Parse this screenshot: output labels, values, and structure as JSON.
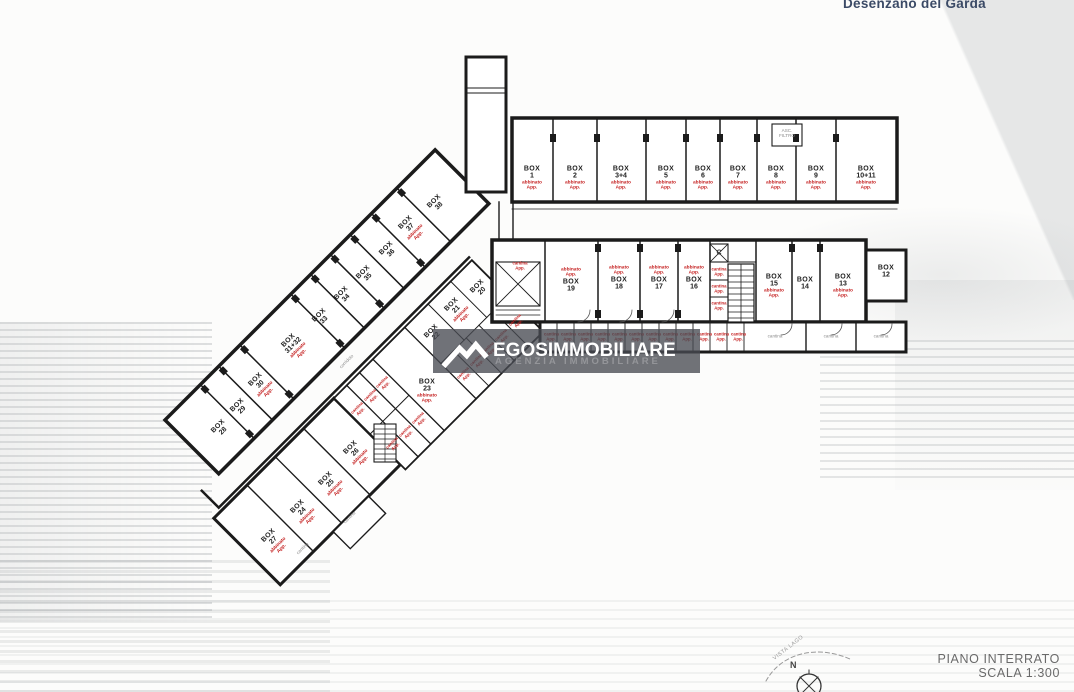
{
  "meta": {
    "location": "Desenzano del Garda"
  },
  "watermark": {
    "brand": "EGOSIMMOBILIARE",
    "subtitle": "AGENZIA IMMOBILIARE"
  },
  "titleblock": {
    "floor": "PIANO INTERRATO",
    "scale": "SCALA 1:300"
  },
  "compass": {
    "north": "N",
    "vista": "VISTA LAGO"
  },
  "strings": {
    "box": "BOX",
    "cantina": "cantina",
    "corridoio": "corridoio",
    "asc": "ASC. FILTRO",
    "elevator": "C",
    "red_generic": "abbinato App.",
    "red_small": "cantina App."
  },
  "plan": {
    "labels": [
      {
        "t": "box",
        "x": 532,
        "y": 178,
        "num": "1",
        "red": 1
      },
      {
        "t": "box",
        "x": 575,
        "y": 178,
        "num": "2",
        "red": 1
      },
      {
        "t": "box",
        "x": 621,
        "y": 178,
        "num": "3+4",
        "red": 1
      },
      {
        "t": "box",
        "x": 666,
        "y": 178,
        "num": "5",
        "red": 1
      },
      {
        "t": "box",
        "x": 703,
        "y": 178,
        "num": "6",
        "red": 1
      },
      {
        "t": "box",
        "x": 738,
        "y": 178,
        "num": "7",
        "red": 1
      },
      {
        "t": "box",
        "x": 776,
        "y": 178,
        "num": "8",
        "red": 1
      },
      {
        "t": "box",
        "x": 816,
        "y": 178,
        "num": "9",
        "red": 1
      },
      {
        "t": "box",
        "x": 866,
        "y": 178,
        "num": "10+11",
        "red": 1
      },
      {
        "t": "box",
        "x": 571,
        "y": 280,
        "num": "19",
        "red": 1,
        "ra": 1
      },
      {
        "t": "box",
        "x": 619,
        "y": 278,
        "num": "18",
        "red": 1,
        "ra": 1
      },
      {
        "t": "box",
        "x": 659,
        "y": 278,
        "num": "17",
        "red": 1,
        "ra": 1
      },
      {
        "t": "box",
        "x": 694,
        "y": 278,
        "num": "16",
        "red": 1,
        "ra": 1
      },
      {
        "t": "box",
        "x": 774,
        "y": 286,
        "num": "15",
        "red": 1
      },
      {
        "t": "box",
        "x": 805,
        "y": 284,
        "num": "14"
      },
      {
        "t": "box",
        "x": 843,
        "y": 286,
        "num": "13",
        "red": 1
      },
      {
        "t": "box",
        "x": 886,
        "y": 272,
        "num": "12"
      },
      {
        "t": "box",
        "x": 221,
        "y": 429,
        "num": "28",
        "rot": 1
      },
      {
        "t": "box",
        "x": 240,
        "y": 408,
        "num": "29",
        "rot": 1
      },
      {
        "t": "box",
        "x": 262,
        "y": 386,
        "num": "30",
        "rot": 1,
        "red": 1
      },
      {
        "t": "box",
        "x": 295,
        "y": 347,
        "num": "31+32",
        "rot": 1,
        "red": 1
      },
      {
        "t": "box",
        "x": 322,
        "y": 318,
        "num": "33",
        "rot": 1
      },
      {
        "t": "box",
        "x": 344,
        "y": 296,
        "num": "34",
        "rot": 1
      },
      {
        "t": "box",
        "x": 366,
        "y": 275,
        "num": "35",
        "rot": 1
      },
      {
        "t": "box",
        "x": 389,
        "y": 251,
        "num": "36",
        "rot": 1
      },
      {
        "t": "box",
        "x": 412,
        "y": 229,
        "num": "37",
        "rot": 1,
        "red": 1
      },
      {
        "t": "box",
        "x": 437,
        "y": 204,
        "num": "38",
        "rot": 1
      },
      {
        "t": "box",
        "x": 275,
        "y": 542,
        "num": "27",
        "rot": 1,
        "red": 1
      },
      {
        "t": "box",
        "x": 304,
        "y": 513,
        "num": "24",
        "rot": 1,
        "red": 1
      },
      {
        "t": "box",
        "x": 332,
        "y": 485,
        "num": "25",
        "rot": 1,
        "red": 1
      },
      {
        "t": "box",
        "x": 357,
        "y": 454,
        "num": "26",
        "rot": 1,
        "red": 1
      },
      {
        "t": "box",
        "x": 427,
        "y": 391,
        "num": "23",
        "red": 1
      },
      {
        "t": "box",
        "x": 434,
        "y": 334,
        "num": "22",
        "rot": 1
      },
      {
        "t": "box",
        "x": 458,
        "y": 311,
        "num": "21",
        "rot": 1,
        "red": 1
      },
      {
        "t": "box",
        "x": 480,
        "y": 289,
        "num": "20",
        "rot": 1
      },
      {
        "t": "red",
        "x": 551,
        "y": 337,
        "w": 14
      },
      {
        "t": "red",
        "x": 568,
        "y": 337,
        "w": 14
      },
      {
        "t": "red",
        "x": 585,
        "y": 337,
        "w": 14
      },
      {
        "t": "red",
        "x": 602,
        "y": 337,
        "w": 14
      },
      {
        "t": "red",
        "x": 619,
        "y": 337,
        "w": 14
      },
      {
        "t": "red",
        "x": 636,
        "y": 337,
        "w": 14
      },
      {
        "t": "red",
        "x": 653,
        "y": 337,
        "w": 14
      },
      {
        "t": "red",
        "x": 670,
        "y": 337,
        "w": 14
      },
      {
        "t": "red",
        "x": 687,
        "y": 337,
        "w": 14
      },
      {
        "t": "red",
        "x": 704,
        "y": 337,
        "w": 14
      },
      {
        "t": "red",
        "x": 721,
        "y": 337,
        "w": 14
      },
      {
        "t": "red",
        "x": 738,
        "y": 337,
        "w": 14
      },
      {
        "t": "red",
        "x": 719,
        "y": 272,
        "w": 15
      },
      {
        "t": "red",
        "x": 719,
        "y": 289,
        "w": 15
      },
      {
        "t": "red",
        "x": 719,
        "y": 306,
        "w": 15
      },
      {
        "t": "red",
        "x": 520,
        "y": 266,
        "w": 16
      },
      {
        "t": "red",
        "x": 359,
        "y": 410,
        "w": 15,
        "rot": 1
      },
      {
        "t": "red",
        "x": 372,
        "y": 397,
        "w": 15,
        "rot": 1
      },
      {
        "t": "red",
        "x": 384,
        "y": 384,
        "w": 15,
        "rot": 1
      },
      {
        "t": "red",
        "x": 394,
        "y": 445,
        "w": 15,
        "rot": 1
      },
      {
        "t": "red",
        "x": 407,
        "y": 433,
        "w": 15,
        "rot": 1
      },
      {
        "t": "red",
        "x": 420,
        "y": 420,
        "w": 15,
        "rot": 1
      },
      {
        "t": "red",
        "x": 465,
        "y": 375,
        "w": 15,
        "rot": 1
      },
      {
        "t": "red",
        "x": 478,
        "y": 362,
        "w": 15,
        "rot": 1
      },
      {
        "t": "red",
        "x": 490,
        "y": 350,
        "w": 15,
        "rot": 1
      },
      {
        "t": "red",
        "x": 503,
        "y": 337,
        "w": 15,
        "rot": 1
      },
      {
        "t": "red",
        "x": 517,
        "y": 322,
        "w": 15,
        "rot": 1
      },
      {
        "t": "grey",
        "x": 775,
        "y": 337,
        "text": "cantina"
      },
      {
        "t": "grey",
        "x": 831,
        "y": 337,
        "text": "cantina"
      },
      {
        "t": "grey",
        "x": 881,
        "y": 337,
        "text": "cantina"
      },
      {
        "t": "grey",
        "x": 303,
        "y": 549,
        "text": "cantina",
        "rot": 1
      },
      {
        "t": "grey",
        "x": 350,
        "y": 518,
        "text": "cantina",
        "rot": 1
      },
      {
        "t": "grey",
        "x": 347,
        "y": 362,
        "text": "corridoio",
        "rot": 1
      },
      {
        "t": "grey",
        "x": 787,
        "y": 134,
        "text": "asc",
        "w": 24
      },
      {
        "t": "grey",
        "x": 719,
        "y": 253,
        "text": "elevator",
        "cls": "dark"
      }
    ]
  }
}
